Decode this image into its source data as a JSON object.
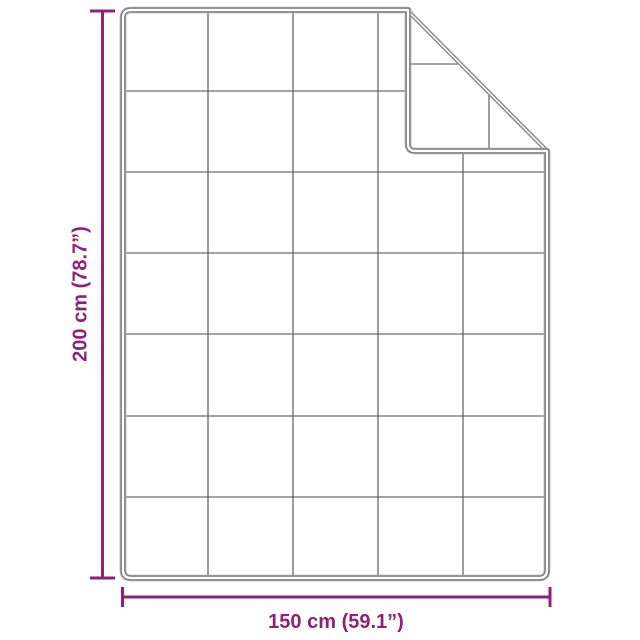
{
  "page": {
    "title": "Product dimension diagram",
    "description": "Quilted blanket shown flat with top-right corner folded over, with height and width dimension lines"
  },
  "colors": {
    "dimension": "#8e2179",
    "edge": "#a2a2a2",
    "edge-inner": "#707070",
    "grid": "#5a5a5a",
    "background": "#ffffff"
  },
  "dimensions": {
    "height": {
      "value_cm": "200",
      "value_inches": "78.7",
      "label": "200 cm (78.7”)"
    },
    "width": {
      "value_cm": "150",
      "value_inches": "59.1",
      "label": "150 cm (59.1”)"
    }
  },
  "blanket": {
    "grid_columns": 5,
    "grid_rows": 7,
    "fold": "top-right corner folded over showing diagonal fold line"
  }
}
